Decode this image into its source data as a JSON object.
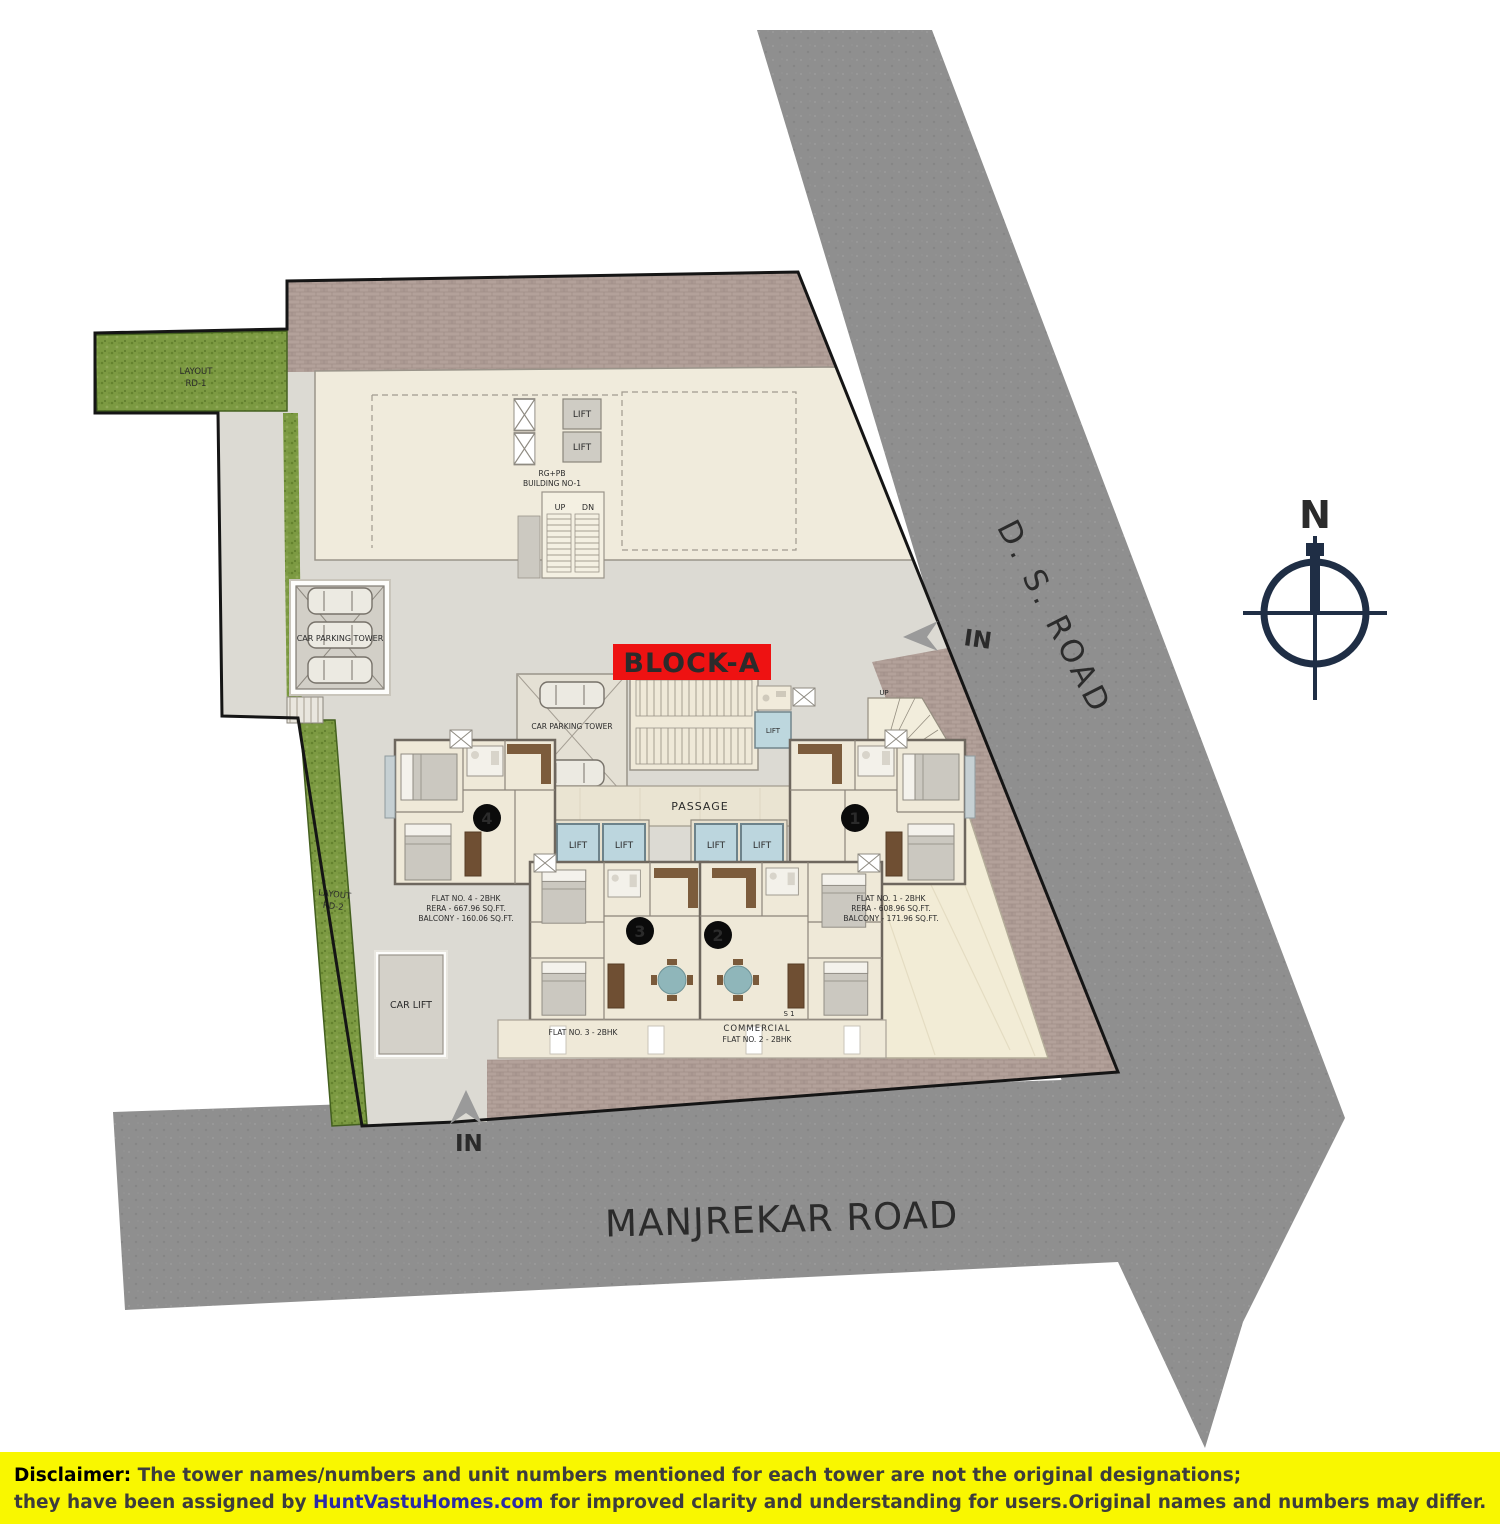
{
  "block_label": "BLOCK-A",
  "roads": {
    "ds_road": "D. S. ROAD",
    "manjrekar_road": "MANJREKAR ROAD"
  },
  "compass": {
    "north_label": "N"
  },
  "gates": {
    "east_in": "IN",
    "south_in": "IN"
  },
  "labels": {
    "lift": "LIFT",
    "up": "UP",
    "down": "DN",
    "passage": "PASSAGE",
    "car_parking_tower": "CAR PARKING TOWER",
    "car_lift": "CAR LIFT",
    "building_name_line1": "RG+PB",
    "building_name_line2": "BUILDING NO-1",
    "layout_road_word": "LAYOUT",
    "layout_rd1": "RD-1",
    "layout_rd2": "RD-2",
    "commercial": "COMMERCIAL",
    "shop": "S 1"
  },
  "units": [
    {
      "badge": "1",
      "name": "FLAT NO. 1 - 2BHK",
      "rera": "RERA - 608.96 SQ.FT.",
      "balcony": "BALCONY - 171.96 SQ.FT."
    },
    {
      "badge": "2",
      "name": "FLAT NO. 2 - 2BHK"
    },
    {
      "badge": "3",
      "name": "FLAT NO. 3 - 2BHK"
    },
    {
      "badge": "4",
      "name": "FLAT NO. 4 - 2BHK",
      "rera": "RERA - 667.96 SQ.FT.",
      "balcony": "BALCONY - 160.06 SQ.FT."
    }
  ],
  "disclaimer": {
    "label": "Disclaimer:",
    "line1": " The tower names/numbers and unit numbers mentioned for each tower are not the original designations;",
    "line2_prefix": "they have been assigned by ",
    "brand": "HuntVastuHomes.com",
    "line2_suffix": " for improved clarity and understanding for users.Original names and numbers may differ."
  },
  "colors": {
    "accent_red": "#ed1c24",
    "disclaimer_yellow": "#f9f700",
    "brand_blue": "#2b2ba6",
    "road_gray": "#8f8f8f",
    "brick": "#b3a19a",
    "grass_green": "#7c9a42",
    "floor_beige": "#efe9d8",
    "lift_blue": "#bdd7de",
    "compass_navy": "#1f2e45"
  }
}
